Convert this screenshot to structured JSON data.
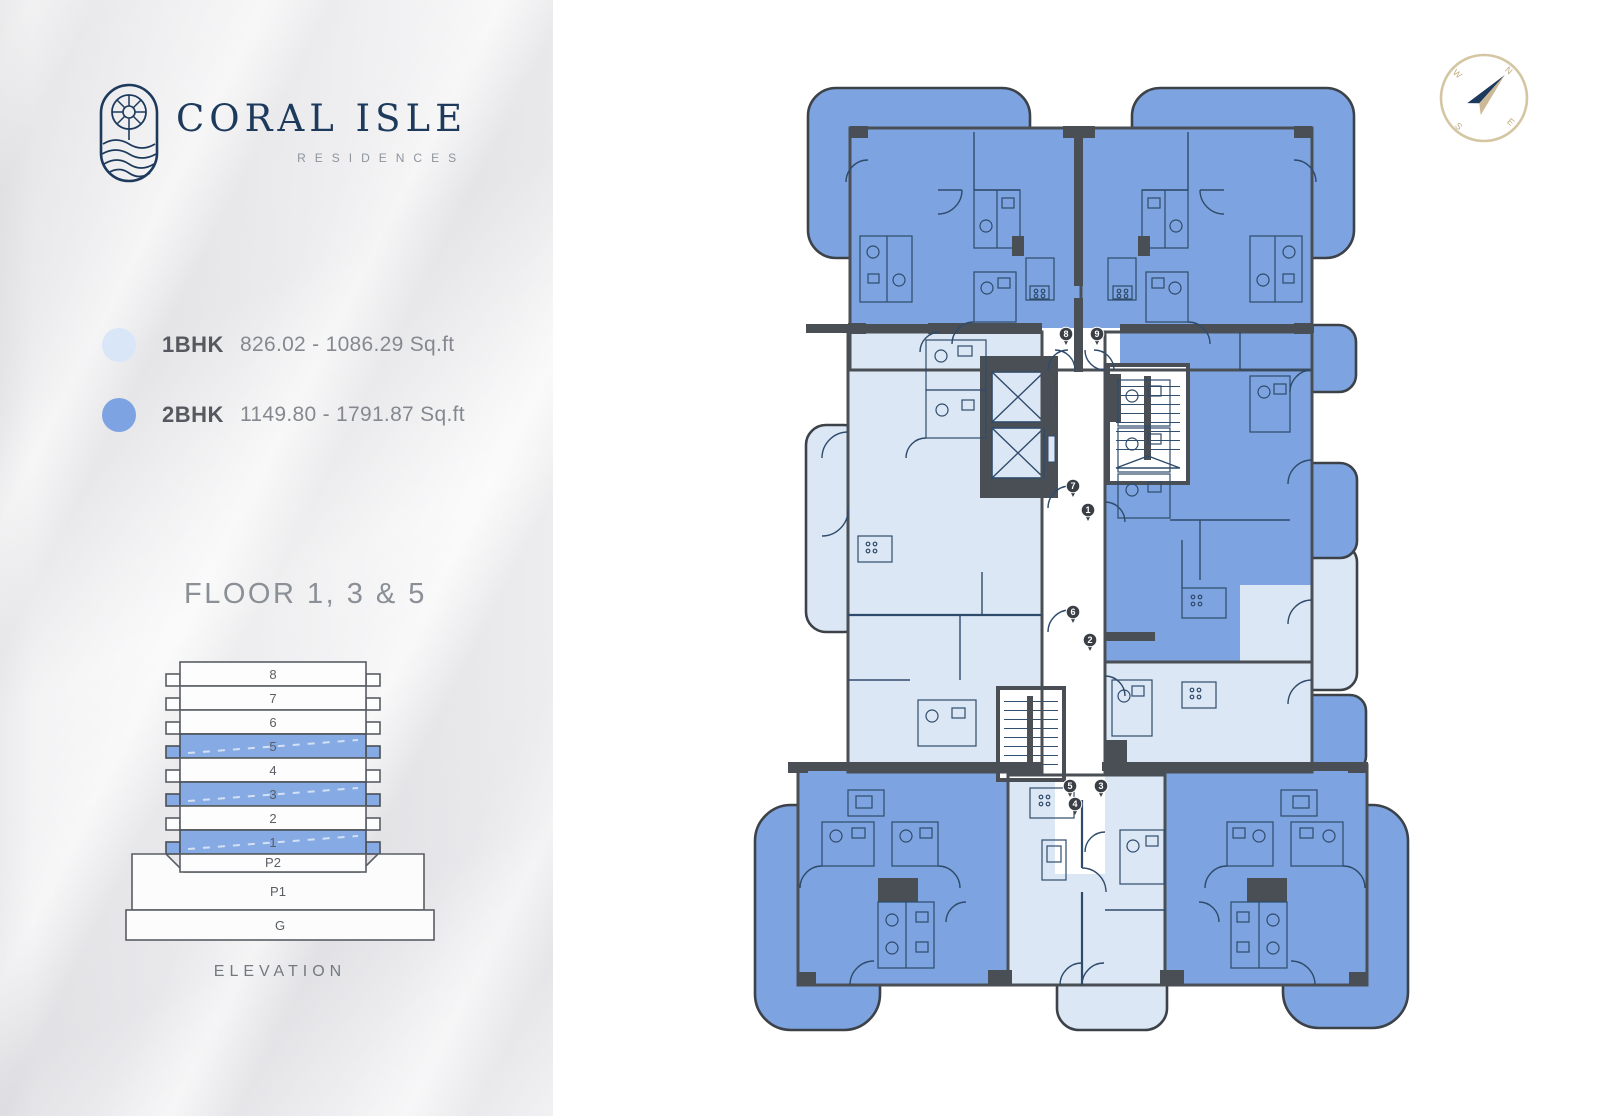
{
  "sidebar": {
    "logo": {
      "title": "CORAL ISLE",
      "subtitle": "RESIDENCES"
    },
    "legend": [
      {
        "type": "1BHK",
        "range": "826.02 - 1086.29 Sq.ft",
        "color": "#d9e6f8"
      },
      {
        "type": "2BHK",
        "range": "1149.80 - 1791.87 Sq.ft",
        "color": "#7da3e2"
      }
    ],
    "floor_title": "FLOOR 1, 3 & 5",
    "elevation": {
      "caption": "ELEVATION",
      "floors": [
        {
          "label": "8",
          "highlight": false
        },
        {
          "label": "7",
          "highlight": false
        },
        {
          "label": "6",
          "highlight": false
        },
        {
          "label": "5",
          "highlight": true
        },
        {
          "label": "4",
          "highlight": false
        },
        {
          "label": "3",
          "highlight": true
        },
        {
          "label": "2",
          "highlight": false
        },
        {
          "label": "1",
          "highlight": true
        }
      ],
      "podium": [
        "P2",
        "P1",
        "G"
      ]
    }
  },
  "compass": {
    "points": [
      "N",
      "E",
      "S",
      "W"
    ]
  },
  "floorplan": {
    "unit_markers": [
      {
        "number": "8",
        "x": 336,
        "y": 295
      },
      {
        "number": "9",
        "x": 367,
        "y": 295
      },
      {
        "number": "7",
        "x": 343,
        "y": 447
      },
      {
        "number": "1",
        "x": 358,
        "y": 471
      },
      {
        "number": "6",
        "x": 343,
        "y": 573
      },
      {
        "number": "2",
        "x": 360,
        "y": 601
      },
      {
        "number": "5",
        "x": 340,
        "y": 747
      },
      {
        "number": "3",
        "x": 371,
        "y": 747
      },
      {
        "number": "4",
        "x": 345,
        "y": 765
      }
    ]
  },
  "colors": {
    "unit_1bhk": "#dce7f5",
    "unit_2bhk": "#7da4e0",
    "wall": "#4a4f55",
    "line": "#2f4b6b",
    "logo_navy": "#1d3a5c",
    "compass_tan": "#cdb996"
  }
}
